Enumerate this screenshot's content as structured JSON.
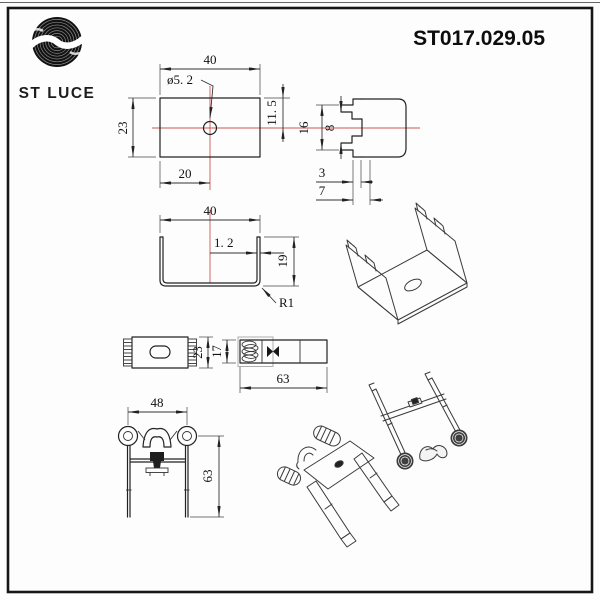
{
  "header": {
    "brand": "ST LUCE",
    "part_number": "ST017.029.05"
  },
  "dims": {
    "plate_width": "40",
    "plate_hole": "ø5. 2",
    "plate_height": "23",
    "plate_hole_x": "20",
    "plate_hole_y": "11. 5",
    "profile_outer": "16",
    "profile_inner": "8",
    "profile_lip": "3",
    "profile_depth": "7",
    "channel_width": "40",
    "channel_thickness": "1. 2",
    "channel_height": "19",
    "channel_radius": "R1",
    "clip_top_height": "23",
    "clip_side_height": "17",
    "clip_side_length": "63",
    "clip_front_width": "48",
    "clip_front_height": "63"
  }
}
